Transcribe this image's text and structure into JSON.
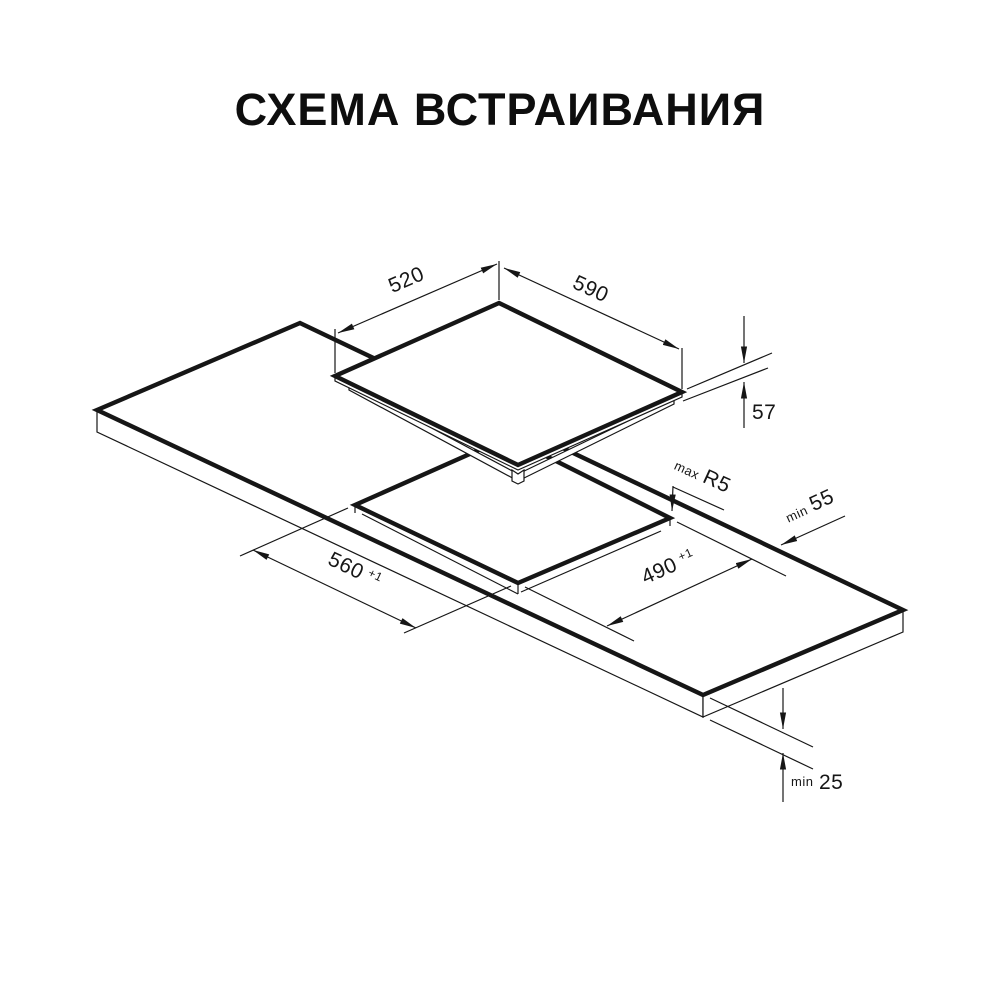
{
  "title": "СХЕМА ВСТРАИВАНИЯ",
  "colors": {
    "line": "#161616",
    "background": "#ffffff"
  },
  "dimensions": {
    "hob_top_depth": "520",
    "hob_top_width": "590",
    "hob_height": "57",
    "cutout_length": "560",
    "cutout_length_tolerance": "+1",
    "cutout_depth": "490",
    "cutout_depth_tolerance": "+1",
    "corner_radius_label": "max",
    "corner_radius_value": "R5",
    "rear_clearance_label": "min",
    "rear_clearance_value": "55",
    "bottom_clearance_label": "min",
    "bottom_clearance_value": "25"
  }
}
